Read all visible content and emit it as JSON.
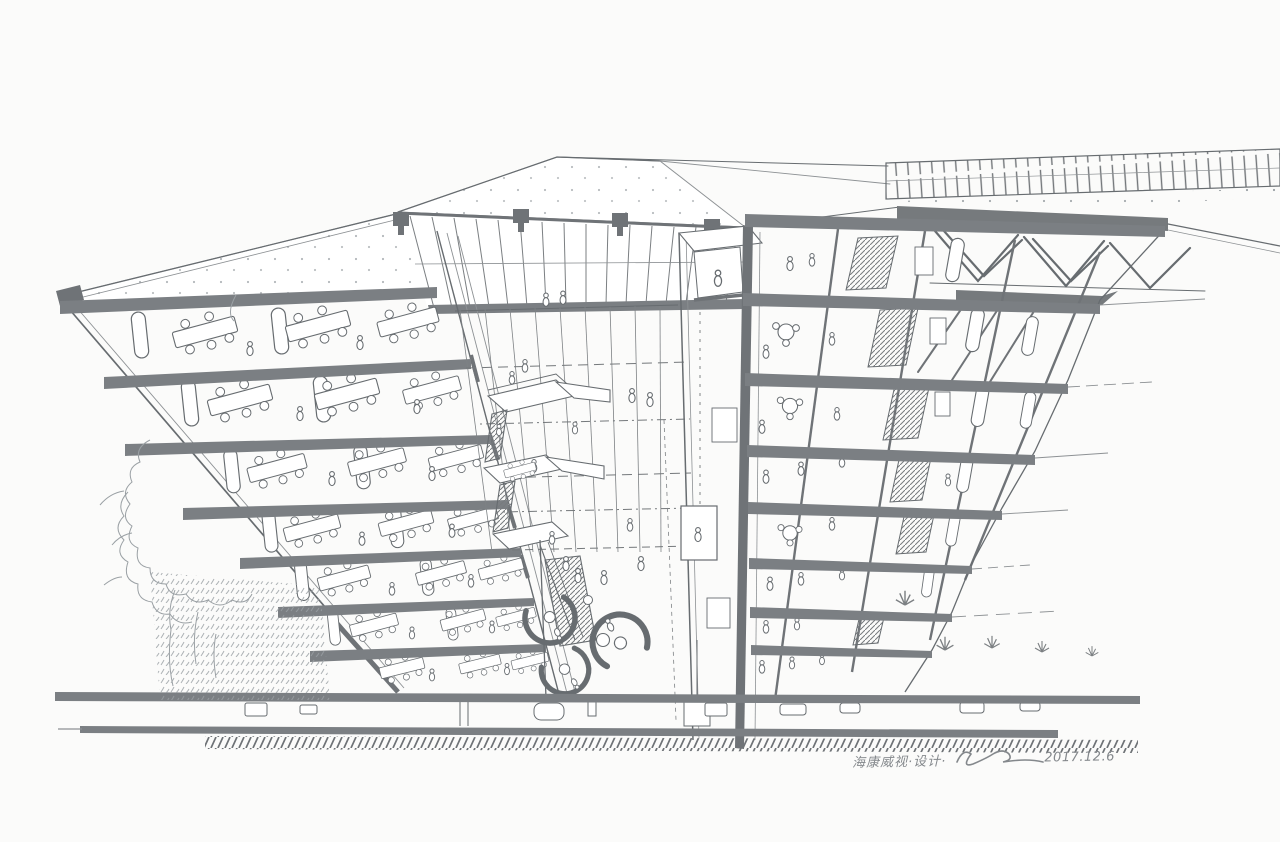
{
  "artwork": {
    "kind": "hand-drawn sectional perspective sketch of a multi-storey office building with central atrium",
    "inscription": {
      "project_text": "海康威视·设计·",
      "date": "2017.12.6"
    },
    "palette": {
      "paper": "#fbfbfa",
      "ink": "#676c70",
      "marker_gray": "#7b7f83",
      "light_pencil": "#9aa0a4"
    }
  }
}
